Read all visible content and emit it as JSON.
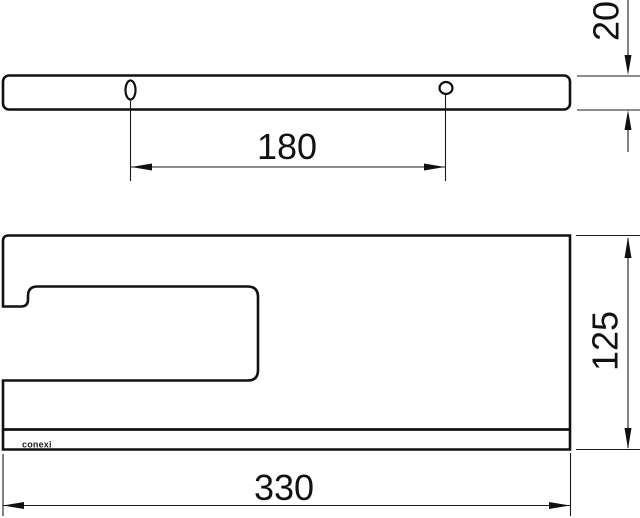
{
  "drawing": {
    "views": {
      "side": {
        "description": "side profile bar with two mounting holes",
        "dims": {
          "hole_spacing": "180",
          "thickness": "20"
        }
      },
      "top": {
        "description": "plan view with towel-hook slot cutout",
        "dims": {
          "width": "330",
          "depth": "125"
        },
        "logo_text": "conexi"
      }
    },
    "colors": {
      "line": "#111111",
      "background": "#ffffff"
    }
  }
}
